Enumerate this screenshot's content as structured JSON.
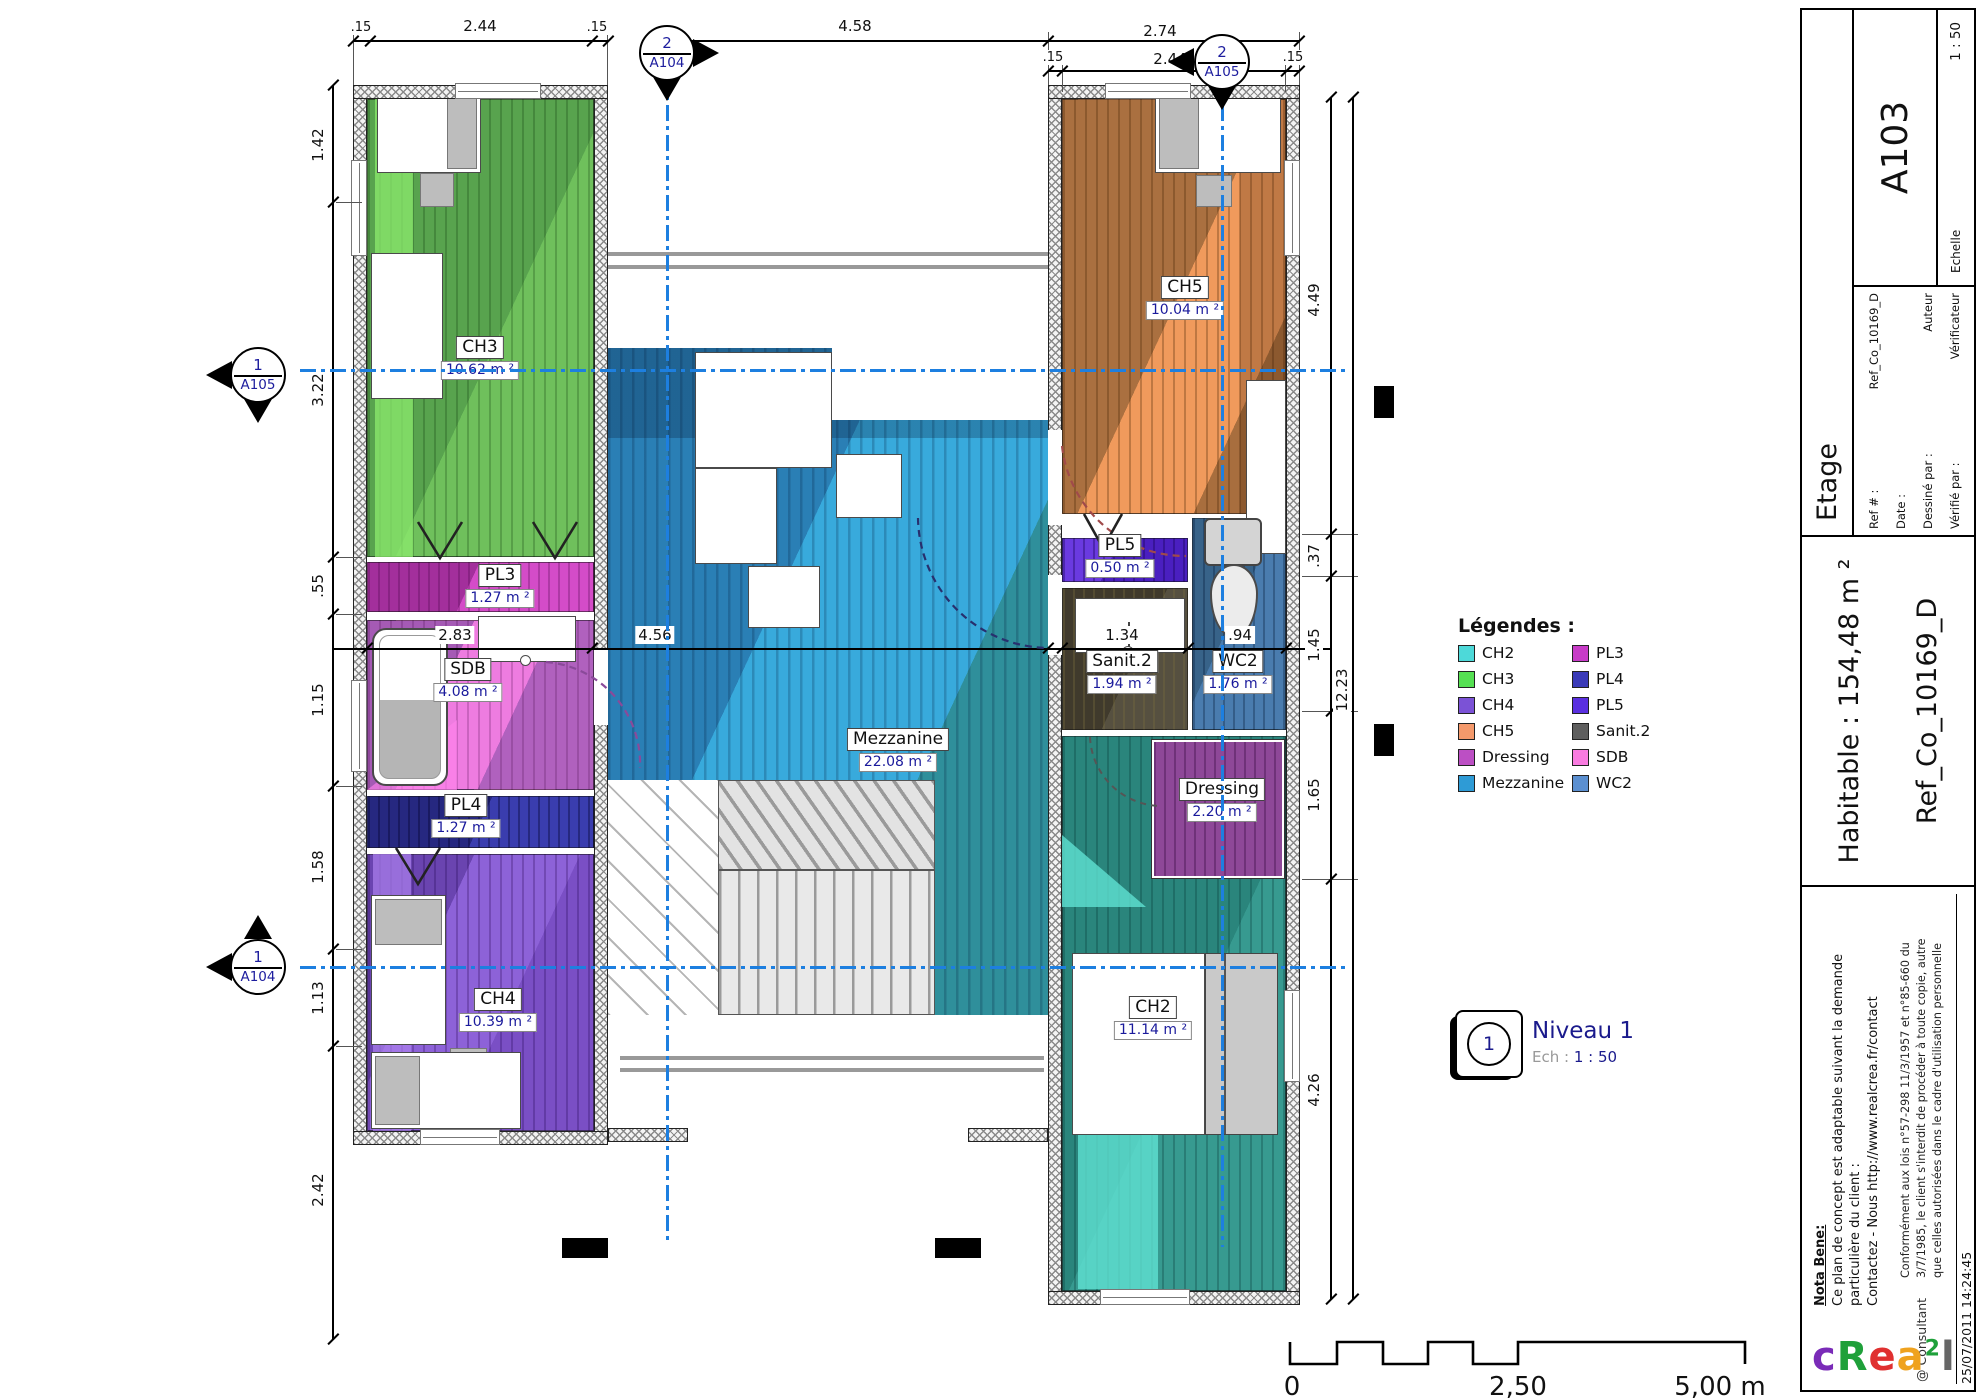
{
  "sheet": {
    "code": "A103",
    "section_title": "Etage",
    "scale_label": "Echelle",
    "scale_value": "1 : 50",
    "ref_label": "Ref # :",
    "ref_value": "Ref_Co_10169_D",
    "date_label": "Date :",
    "drawn_label": "Dessiné par :",
    "drawn_value": "Auteur",
    "checked_label": "Vérifié par :",
    "checked_value": "Vérificateur",
    "habitable": "Habitable : 154,48 m ²",
    "ref_big": "Ref_Co_10169_D",
    "nota_title": "Nota Bene:",
    "nota_line1": "Ce plan de concept est adaptable suivant la demande",
    "nota_line2": "particulière du client :",
    "nota_line3": "Contactez - Nous http://www.realcrea.fr/contact",
    "legal_line1": "Conformément aux lois n°57-298 11/3/1957 et n°85-660 du",
    "legal_line2": "3/7/1985, le client s'interdit de procéder à toute copie, autre",
    "legal_line3": "que celles autorisées dans le cadre d'utilisation personnelle",
    "consultant": "@ Consultant",
    "timestamp": "25/07/2011 14:24:45",
    "logo": {
      "c": "c",
      "r": "R",
      "e": "e",
      "a": "a",
      "sup": "2",
      "l": "l"
    }
  },
  "plan": {
    "rooms": {
      "ch3": {
        "name": "CH3",
        "area": "10.62 m ²"
      },
      "pl3": {
        "name": "PL3",
        "area": "1.27 m ²"
      },
      "sdb": {
        "name": "SDB",
        "area": "4.08 m ²"
      },
      "pl4": {
        "name": "PL4",
        "area": "1.27 m ²"
      },
      "ch4": {
        "name": "CH4",
        "area": "10.39 m ²"
      },
      "ch5": {
        "name": "CH5",
        "area": "10.04 m ²"
      },
      "pl5": {
        "name": "PL5",
        "area": "0.50 m ²"
      },
      "sanit2": {
        "name": "Sanit.2",
        "area": "1.94 m ²"
      },
      "wc2": {
        "name": "WC2",
        "area": "1.76 m ²"
      },
      "dressing": {
        "name": "Dressing",
        "area": "2.20 m ²"
      },
      "mezzanine": {
        "name": "Mezzanine",
        "area": "22.08 m ²"
      },
      "ch2": {
        "name": "CH2",
        "area": "11.14 m ²"
      }
    },
    "markers": {
      "top_left": {
        "num": "2",
        "ref": "A104"
      },
      "top_right": {
        "num": "2",
        "ref": "A105"
      },
      "left_upper": {
        "num": "1",
        "ref": "A105"
      },
      "left_lower": {
        "num": "1",
        "ref": "A104"
      }
    },
    "dims": {
      "top_wall_l": ".15",
      "top_ch3": "2.44",
      "top_wall_r": ".15",
      "top_mid": "4.58",
      "top_right_total": "2.74",
      "top_right_inner": "2.44",
      "top_right_wl": ".15",
      "top_right_wr": ".15",
      "left_1": "1.42",
      "left_2": "3.22",
      "left_3": ".55",
      "left_4": "1.15",
      "left_5": "1.58",
      "left_6": "1.13",
      "left_7": "2.42",
      "mid_1": "2.83",
      "mid_2": "4.56",
      "mid_3": "1.34",
      "mid_4": ".94",
      "right_1": "4.49",
      "right_2": ".37",
      "right_3": "1.45",
      "right_4": "1.65",
      "right_5": "4.26",
      "right_total": "12.23"
    }
  },
  "legend": {
    "title": "Légendes :",
    "items": [
      {
        "label": "CH2",
        "color": "#4dd9d9"
      },
      {
        "label": "CH3",
        "color": "#55e052"
      },
      {
        "label": "CH4",
        "color": "#7b52d6"
      },
      {
        "label": "CH5",
        "color": "#f4996b"
      },
      {
        "label": "Dressing",
        "color": "#bc4fc4"
      },
      {
        "label": "Mezzanine",
        "color": "#2e9bd6"
      },
      {
        "label": "PL3",
        "color": "#c73bc7"
      },
      {
        "label": "PL4",
        "color": "#3a3ab8"
      },
      {
        "label": "PL5",
        "color": "#5a2fe0"
      },
      {
        "label": "Sanit.2",
        "color": "#5e5e5e"
      },
      {
        "label": "SDB",
        "color": "#f97be0"
      },
      {
        "label": "WC2",
        "color": "#5b8fd0"
      }
    ]
  },
  "level_badge": {
    "num": "1",
    "title": "Niveau 1",
    "ech_label": "Ech :",
    "ech_value": "1 : 50"
  },
  "scalebar": {
    "zero": "0",
    "mid": "2,50",
    "end": "5,00 m"
  }
}
